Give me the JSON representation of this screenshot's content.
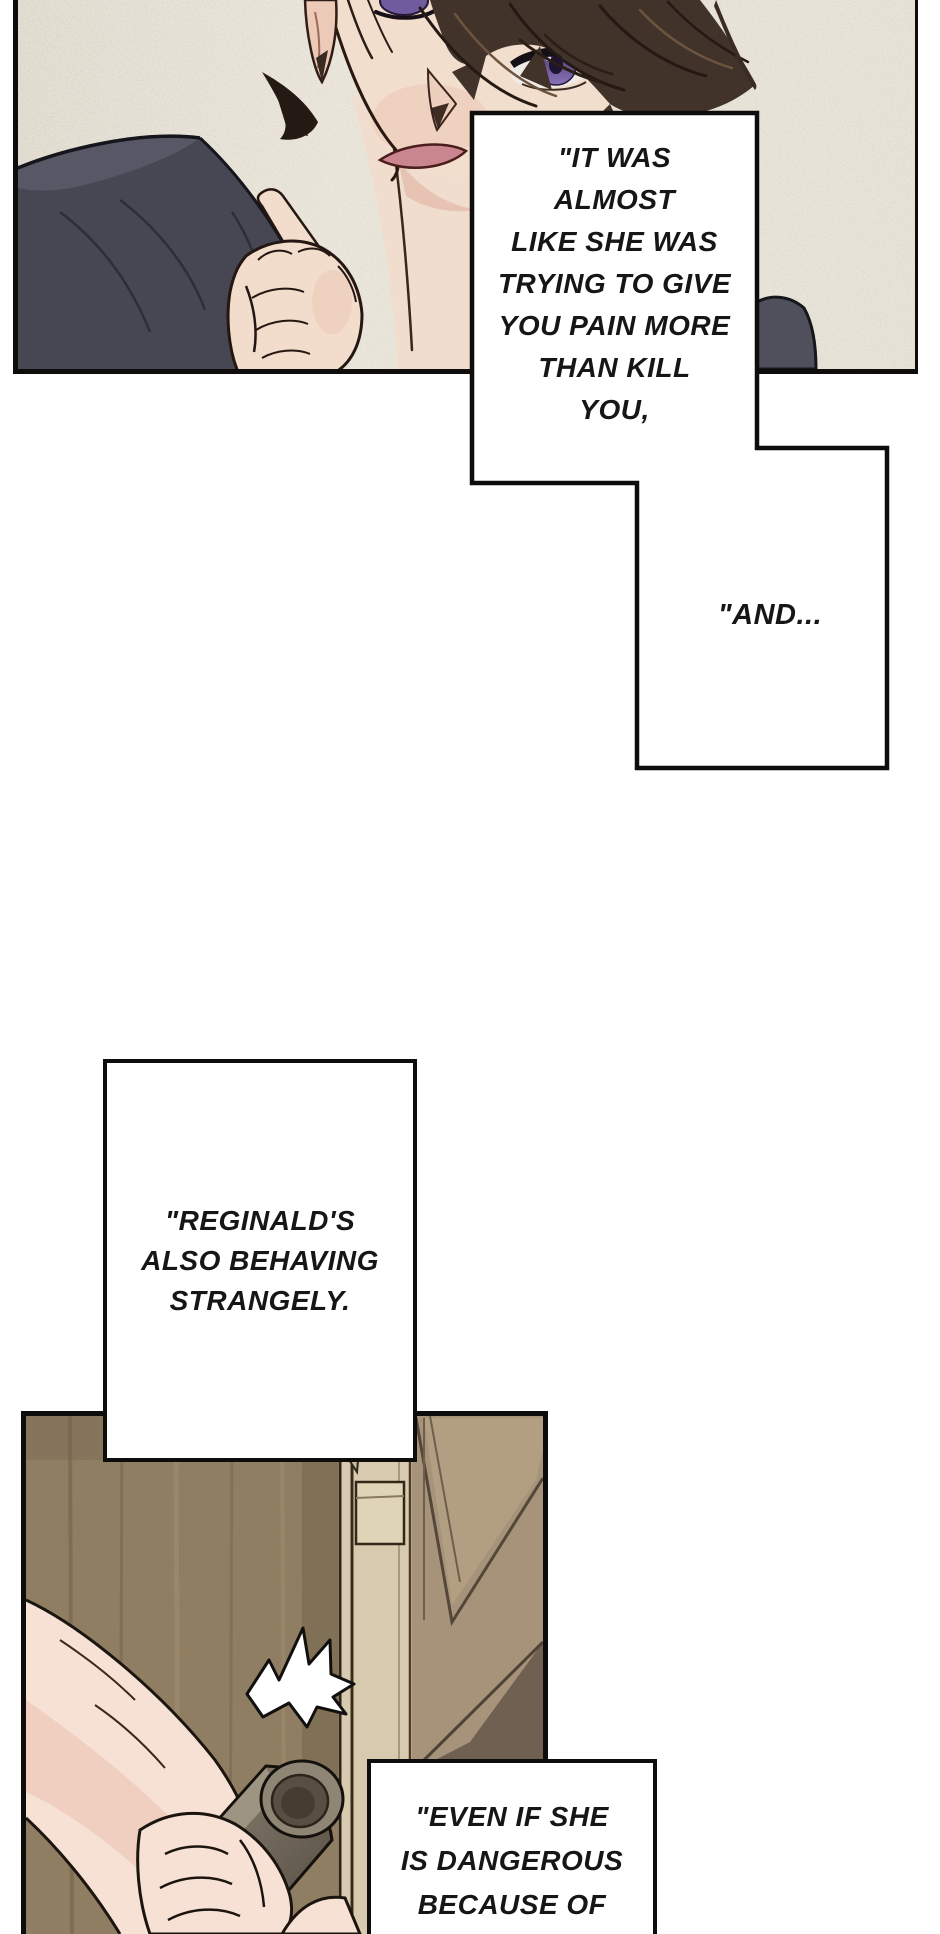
{
  "page": {
    "type": "webtoon-comic-page",
    "background": "#ffffff"
  },
  "panels": [
    {
      "id": "panel-top",
      "description": "Close-up of a dark-haired man with violet eyes, hand raised to his chin, dark blue-grey clothing, beige textured background"
    },
    {
      "id": "panel-bottom",
      "description": "A hand reaching from the left gripping a dark round door handle beside a wooden door, with a white motion flash"
    }
  ],
  "speech_bubbles": [
    {
      "id": "bubble-1",
      "lines": [
        "\"IT WAS",
        "ALMOST",
        "LIKE SHE WAS",
        "TRYING TO GIVE",
        "YOU PAIN MORE",
        "THAN KILL",
        "YOU,"
      ]
    },
    {
      "id": "bubble-2",
      "lines": [
        "\"AND..."
      ]
    },
    {
      "id": "bubble-3",
      "lines": [
        "\"REGINALD'S",
        "ALSO BEHAVING",
        "STRANGELY."
      ]
    },
    {
      "id": "bubble-4",
      "lines": [
        "\"EVEN IF SHE",
        "IS DANGEROUS",
        "BECAUSE OF"
      ]
    }
  ],
  "palette": {
    "panel_border": "#0e0d0b",
    "bubble_fill": "#ffffff",
    "bubble_border": "#0e0d0b",
    "text": "#161616",
    "panel1_background": "#dad2c4",
    "hair": "#41322a",
    "eye_iris": "#6f5b9e",
    "skin": "#f1decd",
    "skin_shadow": "#e4bead",
    "mouth": "#c9868f",
    "clothing": "#474754",
    "panel2_wall": "#8f7d62",
    "door_edge": "#d7caae",
    "door_face": "#a6937a",
    "door_handle": "#584e41",
    "arm_skin": "#f6e1d4",
    "flash": "#ffffff"
  }
}
